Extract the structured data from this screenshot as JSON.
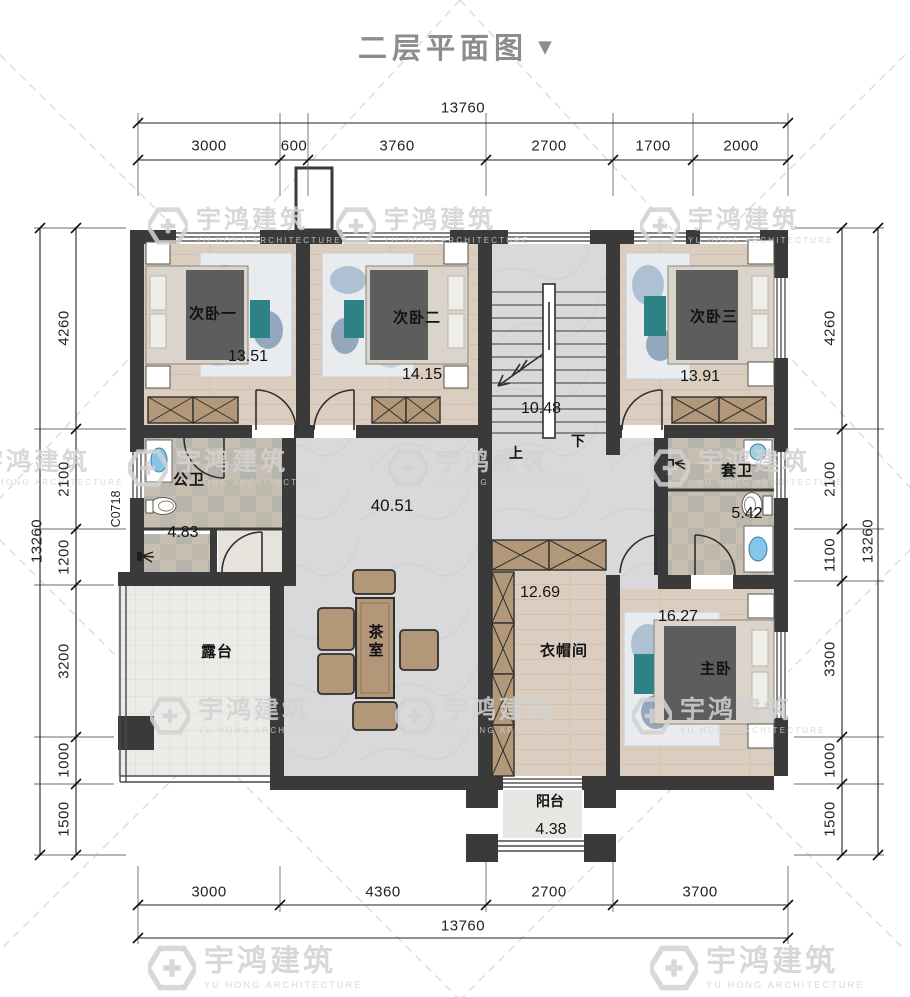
{
  "title": {
    "text": "二层平面图",
    "arrow": "▼"
  },
  "watermark": {
    "name": "宇鸿建筑",
    "subtitle": "YU HONG ARCHITECTURE"
  },
  "dimensions": {
    "top": {
      "total": "13760",
      "segments": [
        "3000",
        "600",
        "3760",
        "2700",
        "1700",
        "2000"
      ]
    },
    "bottom": {
      "total": "13760",
      "segments": [
        "3000",
        "4360",
        "2700",
        "3700"
      ]
    },
    "left": {
      "total": "13260",
      "segments": [
        "4260",
        "2100",
        "1200",
        "3200",
        "1000",
        "1500"
      ]
    },
    "right": {
      "total": "13260",
      "segments": [
        "4260",
        "2100",
        "1100",
        "3300",
        "1000",
        "1500"
      ]
    }
  },
  "rooms": {
    "bedroom1": {
      "name": "次卧一",
      "area": "13.51"
    },
    "bedroom2": {
      "name": "次卧二",
      "area": "14.15"
    },
    "bedroom3": {
      "name": "次卧三",
      "area": "13.91"
    },
    "public_bath": {
      "name": "公卫",
      "area": "4.83"
    },
    "suite_bath": {
      "name": "套卫",
      "area": "5.42"
    },
    "hall": {
      "area": "40.51"
    },
    "stairs": {
      "area": "10.48",
      "up_label": "上",
      "down_label": "下"
    },
    "terrace": {
      "name": "露台"
    },
    "tea_room": {
      "name": "茶室"
    },
    "cloakroom": {
      "name": "衣帽间",
      "area": "12.69"
    },
    "master_bedroom": {
      "name": "主卧",
      "area": "16.27"
    },
    "balcony": {
      "name": "阳台",
      "area": "4.38"
    }
  },
  "annotations": {
    "window_code": "C0718"
  },
  "colors": {
    "wall": "#3a3a3a",
    "wood_floor": "#dbcec0",
    "marble_floor": "#d9d9db",
    "tile_a": "#c7bfb2",
    "tile_b": "#beb8ac",
    "wardrobe": "#b29879",
    "accent_teal": "#2e8286",
    "title_gray": "#8c8c8c",
    "watermark_gray": "#d2d2d2"
  }
}
